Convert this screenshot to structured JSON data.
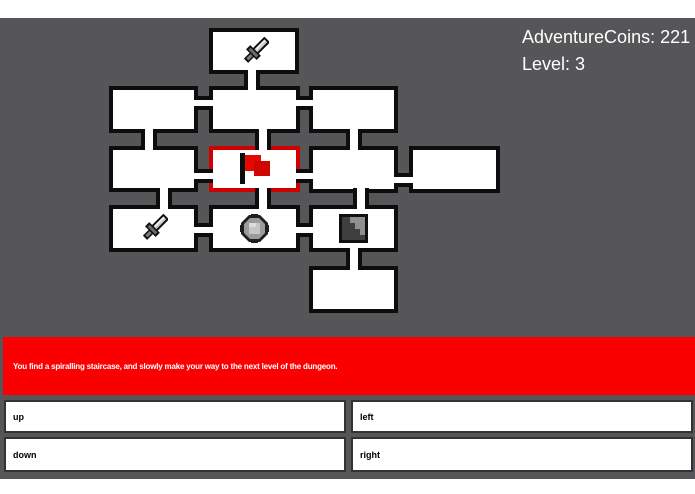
{
  "hud": {
    "coins": "AdventureCoins: 221",
    "level": "Level: 3"
  },
  "message": {
    "text": "You find a spiralling staircase, and slowly make your way to the next level of the dungeon."
  },
  "controls": {
    "up": {
      "label": "up"
    },
    "left": {
      "label": "left"
    },
    "down": {
      "label": "down"
    },
    "right": {
      "label": "right"
    }
  },
  "colors": {
    "game_background": "#565658",
    "room_fill": "#ffffff",
    "wall_outline": "#0d0d0d",
    "current_room_outline": "#d10000",
    "message_background": "#fb0000",
    "message_text": "#ffffff",
    "hud_text": "#ffffff",
    "button_border": "#333333",
    "button_fill": "#ffffff",
    "button_text": "#000000"
  },
  "map": {
    "current_room_id": "center",
    "rooms": [
      {
        "id": "top",
        "x": 209,
        "y": 28,
        "w": 90,
        "h": 46,
        "icon": "sword"
      },
      {
        "id": "row1-left",
        "x": 109,
        "y": 86,
        "w": 89,
        "h": 47
      },
      {
        "id": "row1-mid",
        "x": 209,
        "y": 86,
        "w": 91,
        "h": 47
      },
      {
        "id": "row1-right",
        "x": 309,
        "y": 86,
        "w": 89,
        "h": 47
      },
      {
        "id": "row2-left",
        "x": 109,
        "y": 146,
        "w": 89,
        "h": 46
      },
      {
        "id": "center",
        "x": 209,
        "y": 146,
        "w": 91,
        "h": 46,
        "icon": "flag",
        "current": true
      },
      {
        "id": "row2-right",
        "x": 309,
        "y": 146,
        "w": 89,
        "h": 47
      },
      {
        "id": "row2-far-right",
        "x": 409,
        "y": 146,
        "w": 91,
        "h": 47
      },
      {
        "id": "row3-left",
        "x": 109,
        "y": 205,
        "w": 89,
        "h": 47,
        "icon": "sword"
      },
      {
        "id": "row3-mid",
        "x": 209,
        "y": 205,
        "w": 91,
        "h": 47,
        "icon": "coin"
      },
      {
        "id": "row3-right",
        "x": 309,
        "y": 205,
        "w": 89,
        "h": 47,
        "icon": "stairs"
      },
      {
        "id": "bottom",
        "x": 309,
        "y": 266,
        "w": 89,
        "h": 47
      }
    ],
    "corridors": [
      {
        "dir": "v",
        "x": 244,
        "y": 70,
        "w": 16,
        "h": 20
      },
      {
        "dir": "h",
        "x": 194,
        "y": 96,
        "w": 19,
        "h": 14
      },
      {
        "dir": "h",
        "x": 296,
        "y": 96,
        "w": 17,
        "h": 14
      },
      {
        "dir": "v",
        "x": 141,
        "y": 129,
        "w": 16,
        "h": 21
      },
      {
        "dir": "v",
        "x": 255,
        "y": 129,
        "w": 16,
        "h": 21
      },
      {
        "dir": "v",
        "x": 346,
        "y": 129,
        "w": 16,
        "h": 21
      },
      {
        "dir": "h",
        "x": 194,
        "y": 169,
        "w": 19,
        "h": 14
      },
      {
        "dir": "h",
        "x": 296,
        "y": 169,
        "w": 17,
        "h": 14
      },
      {
        "dir": "h",
        "x": 394,
        "y": 173,
        "w": 19,
        "h": 14
      },
      {
        "dir": "v",
        "x": 156,
        "y": 188,
        "w": 16,
        "h": 21
      },
      {
        "dir": "v",
        "x": 255,
        "y": 188,
        "w": 16,
        "h": 21
      },
      {
        "dir": "v",
        "x": 353,
        "y": 188,
        "w": 16,
        "h": 21
      },
      {
        "dir": "h",
        "x": 194,
        "y": 223,
        "w": 19,
        "h": 14
      },
      {
        "dir": "h",
        "x": 296,
        "y": 223,
        "w": 17,
        "h": 14
      },
      {
        "dir": "v",
        "x": 346,
        "y": 248,
        "w": 16,
        "h": 22
      }
    ]
  }
}
